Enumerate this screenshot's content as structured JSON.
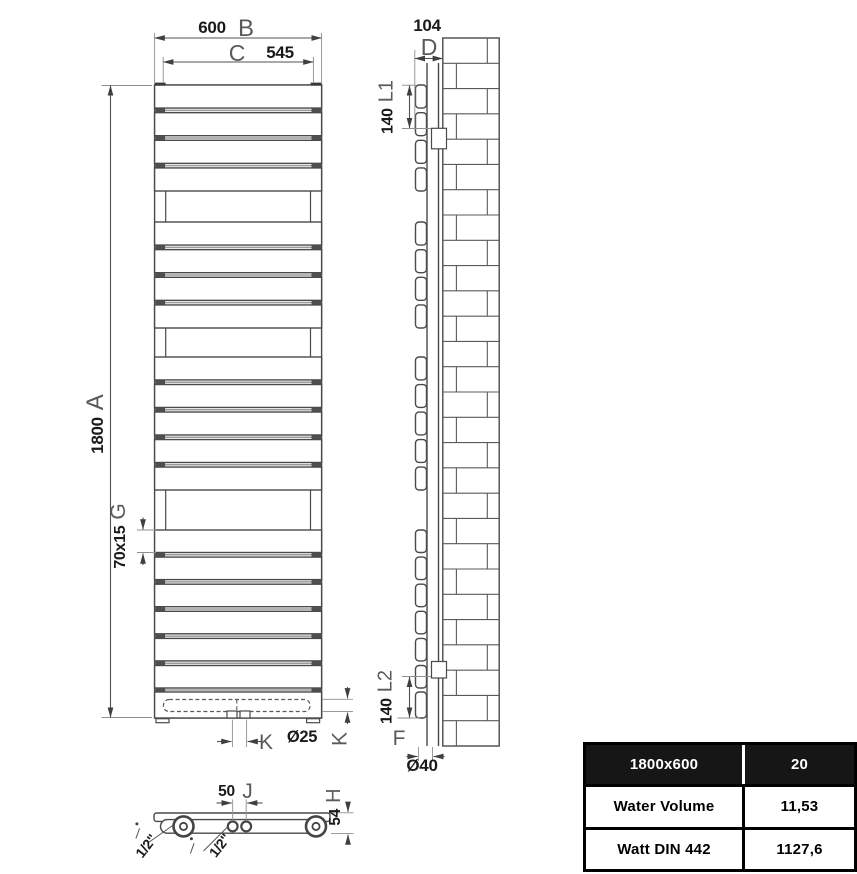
{
  "diagram": {
    "front_view": {
      "panel_groups": [
        4,
        4,
        5,
        6
      ],
      "total_panels": 20,
      "dims": {
        "width": "600",
        "width_letter": "B",
        "inner_width": "545",
        "inner_width_letter": "C",
        "height": "1800",
        "height_letter": "A",
        "panel_profile": "70x15",
        "panel_profile_letter": "G",
        "conn_letter": "K",
        "conn_diameter": "Ø25",
        "collector_letter": "K"
      }
    },
    "side_view": {
      "dims": {
        "depth": "104",
        "depth_letter": "D",
        "bracket_top": "140",
        "bracket_top_letter": "L1",
        "bracket_bottom": "140",
        "bracket_bottom_letter": "L2",
        "tube_letter": "F",
        "tube_diameter": "Ø40"
      }
    },
    "bottom_view": {
      "dims": {
        "conn_spacing": "50",
        "conn_spacing_letter": "J",
        "depth_letter": "H",
        "depth": "54",
        "thread_left": "1/2\"",
        "thread_center": "1/2\""
      }
    }
  },
  "table": {
    "header": {
      "model": "1800x600",
      "panels": "20"
    },
    "rows": [
      {
        "label": "Water Volume",
        "value": "11,53"
      },
      {
        "label": "Watt DIN 442",
        "value": "1127,6"
      }
    ]
  }
}
